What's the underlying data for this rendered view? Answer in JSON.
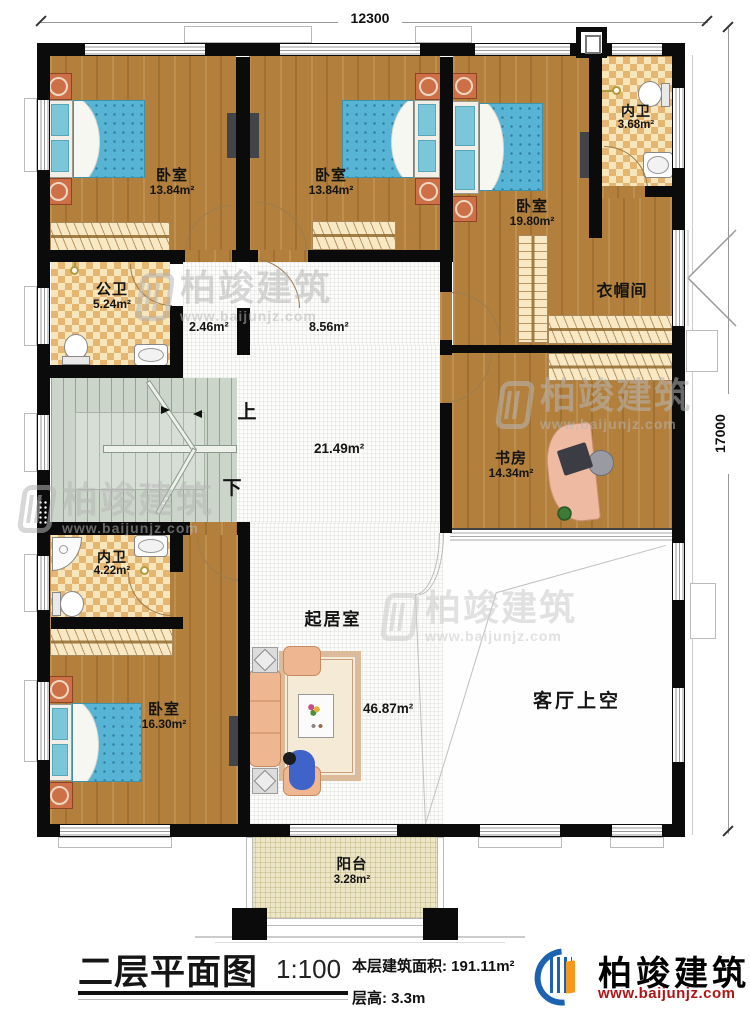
{
  "dimensions": {
    "top": "12300",
    "right": "17000"
  },
  "rooms": {
    "bedroom1": {
      "label": "卧室",
      "area": "13.84m²"
    },
    "bedroom2": {
      "label": "卧室",
      "area": "13.84m²"
    },
    "bedroom3": {
      "label": "卧室",
      "area": "19.80m²"
    },
    "ensuite_top": {
      "label": "内卫",
      "area": "3.68m²"
    },
    "cloakroom": {
      "label": "衣帽间"
    },
    "public_bath": {
      "label": "公卫",
      "area": "5.24m²"
    },
    "vestibule": {
      "area": "2.46m²"
    },
    "hallway": {
      "area": "8.56m²"
    },
    "hall": {
      "area": "21.49m²"
    },
    "study": {
      "label": "书房",
      "area": "14.34m²"
    },
    "ensuite_bottom": {
      "label": "内卫",
      "area": "4.22m²"
    },
    "bedroom4": {
      "label": "卧室",
      "area": "16.30m²"
    },
    "living": {
      "label": "起居室",
      "area": "46.87m²"
    },
    "void": {
      "label": "客厅上空"
    },
    "balcony": {
      "label": "阳台",
      "area": "3.28m²"
    }
  },
  "stairs": {
    "up": "上",
    "down": "下"
  },
  "watermark": {
    "brand": "柏竣建筑",
    "url": "www.baijunjz.com"
  },
  "footer": {
    "title": "二层平面图",
    "scale": "1:100",
    "area_label": "本层建筑面积:",
    "area_value": "191.11m²",
    "floor_height_label": "层高:",
    "floor_height_value": "3.3m",
    "brand": "柏竣建筑",
    "url": "www.baijunjz.com"
  }
}
